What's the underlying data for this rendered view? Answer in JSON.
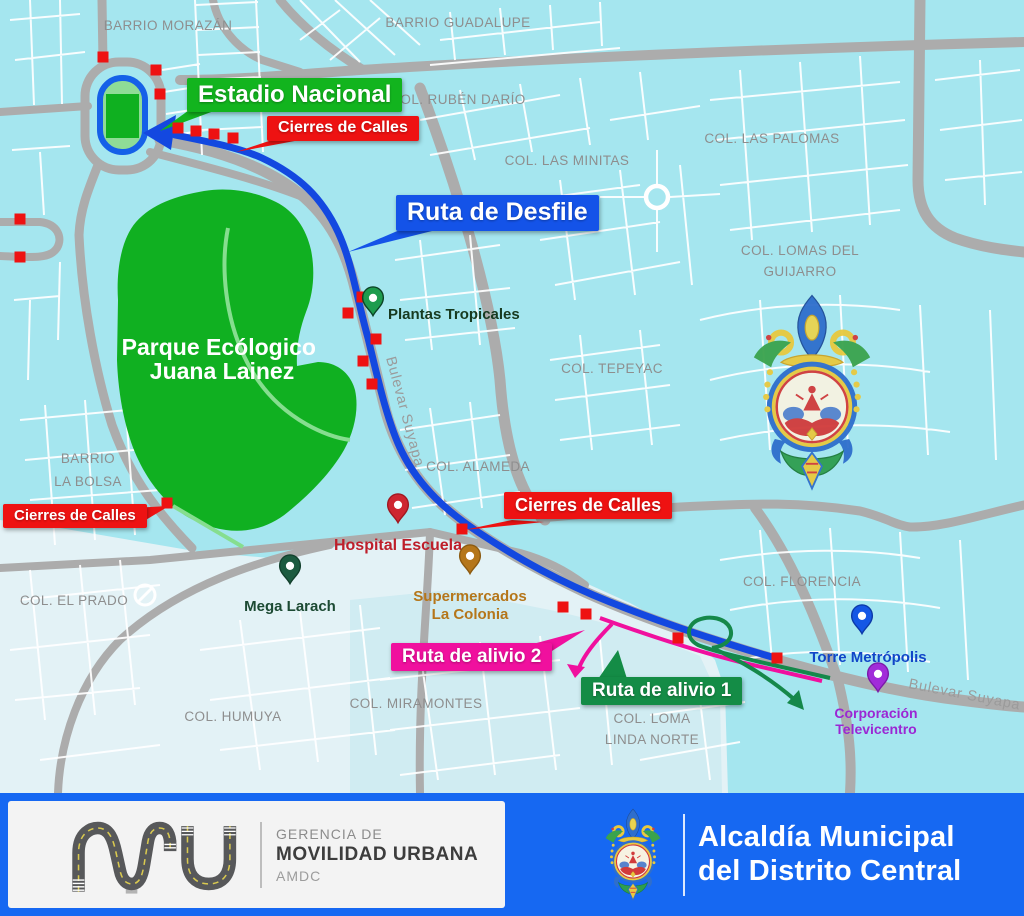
{
  "map": {
    "colors": {
      "map_bg": "#A5E6EF",
      "light_zone": "#E3F2F6",
      "mid_zone": "#CBEAF1",
      "roads": "#ACACAC",
      "streets": "#FFFFFF",
      "park_green": "#10B021",
      "route_desfile_blue": "#1348E0",
      "route_alivio1_green": "#15884A",
      "route_alivio2_pink": "#F0109E",
      "closure_red": "#EE1212"
    },
    "park_name": [
      "Parque Ecólogico",
      "Juana Lainez"
    ],
    "neighborhoods": [
      {
        "lines": [
          "BARRIO MORAZÁN"
        ],
        "x": 168,
        "y": 30
      },
      {
        "lines": [
          "BARRIO GUADALUPE"
        ],
        "x": 458,
        "y": 27
      },
      {
        "lines": [
          "COL. RUBÉN DARÍO"
        ],
        "x": 458,
        "y": 104
      },
      {
        "lines": [
          "COL. LAS MINITAS"
        ],
        "x": 567,
        "y": 165
      },
      {
        "lines": [
          "COL. LAS PALOMAS"
        ],
        "x": 772,
        "y": 143
      },
      {
        "lines": [
          "COL. LOMAS DEL",
          "GUIJARRO"
        ],
        "x": 800,
        "y": 255,
        "lh": 21
      },
      {
        "lines": [
          "COL. TEPEYAC"
        ],
        "x": 612,
        "y": 373
      },
      {
        "lines": [
          "COL. ALAMEDA"
        ],
        "x": 478,
        "y": 471
      },
      {
        "lines": [
          "BARRIO",
          "LA BOLSA"
        ],
        "x": 88,
        "y": 463,
        "lh": 23
      },
      {
        "lines": [
          "COL. EL PRADO"
        ],
        "x": 74,
        "y": 605
      },
      {
        "lines": [
          "COL. FLORENCIA"
        ],
        "x": 802,
        "y": 586
      },
      {
        "lines": [
          "COL. HUMUYA"
        ],
        "x": 233,
        "y": 721
      },
      {
        "lines": [
          "COL. MIRAMONTES"
        ],
        "x": 416,
        "y": 708
      },
      {
        "lines": [
          "COL. LOMA",
          "LINDA NORTE"
        ],
        "x": 652,
        "y": 723,
        "lh": 21
      }
    ],
    "street_names": [
      {
        "text": "Bulevar Suyapa",
        "x": 386,
        "y": 358,
        "rotate": 75
      },
      {
        "text": "Bulevar Suyapa",
        "x": 908,
        "y": 688,
        "rotate": 11
      }
    ],
    "pois": [
      {
        "id": "plantas-tropicales",
        "lines": [
          "Plantas Tropicales"
        ],
        "x": 373,
        "y": 314,
        "pin": "#1E9C4E",
        "pin_stroke": "#0C4426",
        "text_color": "#173A20",
        "tx": 388,
        "ty": 319,
        "anchor": "start",
        "fs": 15,
        "lh": 17
      },
      {
        "id": "hospital-escuela",
        "lines": [
          "Hospital Escuela"
        ],
        "x": 398,
        "y": 521,
        "pin": "#CE2630",
        "pin_stroke": "#A01820",
        "text_color": "#BE1E2A",
        "tx": 398,
        "ty": 550,
        "anchor": "middle",
        "fs": 16,
        "lh": 18
      },
      {
        "id": "mega-larach",
        "lines": [
          "Mega Larach"
        ],
        "x": 290,
        "y": 582,
        "pin": "#1C5B40",
        "pin_stroke": "#12402C",
        "text_color": "#1C4A33",
        "tx": 290,
        "ty": 611,
        "anchor": "middle",
        "fs": 15,
        "lh": 17
      },
      {
        "id": "supermercados-la-colonia",
        "lines": [
          "Supermercados",
          "La Colonia"
        ],
        "x": 470,
        "y": 572,
        "pin": "#B5761A",
        "pin_stroke": "#8C5A10",
        "text_color": "#B5761A",
        "tx": 470,
        "ty": 601,
        "anchor": "middle",
        "fs": 15,
        "lh": 18
      },
      {
        "id": "torre-metropolis",
        "lines": [
          "Torre Metrópolis"
        ],
        "x": 862,
        "y": 632,
        "pin": "#1457E5",
        "pin_stroke": "#0C3AA8",
        "text_color": "#1146C8",
        "tx": 868,
        "ty": 662,
        "anchor": "middle",
        "fs": 15,
        "lh": 17
      },
      {
        "id": "corporacion-televicentro",
        "lines": [
          "Corporación",
          "Televicentro"
        ],
        "x": 878,
        "y": 690,
        "pin": "#A12CD9",
        "pin_stroke": "#7A1BA8",
        "text_color": "#9B27D4",
        "tx": 876,
        "ty": 718,
        "anchor": "middle",
        "fs": 14,
        "lh": 16
      }
    ],
    "closures": [
      [
        103,
        57
      ],
      [
        156,
        70
      ],
      [
        160,
        94
      ],
      [
        20,
        219
      ],
      [
        20,
        257
      ],
      [
        178,
        128
      ],
      [
        196,
        131
      ],
      [
        214,
        134
      ],
      [
        233,
        138
      ],
      [
        362,
        297
      ],
      [
        348,
        313
      ],
      [
        376,
        339
      ],
      [
        363,
        361
      ],
      [
        372,
        384
      ],
      [
        167,
        503
      ],
      [
        462,
        529
      ],
      [
        563,
        607
      ],
      [
        586,
        614
      ],
      [
        678,
        638
      ],
      [
        777,
        658
      ]
    ],
    "callouts": [
      {
        "id": "estadio-nacional",
        "text": "Estadio Nacional",
        "x": 187,
        "y": 78,
        "fs": 24,
        "color": "#12B41E",
        "tail": "192,108 222,108 160,131"
      },
      {
        "id": "cierres-top",
        "text": "Cierres de Calles",
        "x": 267,
        "y": 116,
        "fs": 16,
        "color": "#EE1212",
        "tail": "272,140 300,140 236,152"
      },
      {
        "id": "ruta-desfile",
        "text": "Ruta de Desfile",
        "x": 396,
        "y": 195,
        "fs": 25,
        "color": "#1453E8",
        "tail": "402,229 432,231 348,252"
      },
      {
        "id": "cierres-left",
        "text": "Cierres de Calles",
        "x": 3,
        "y": 504,
        "fs": 15,
        "color": "#EE1212",
        "tail": "132,508 134,527 169,506"
      },
      {
        "id": "cierres-center",
        "text": "Cierres de Calles",
        "x": 504,
        "y": 492,
        "fs": 18,
        "color": "#EE1212",
        "tail": "512,520 544,522 464,530"
      },
      {
        "id": "ruta-alivio-2",
        "text": "Ruta de alivio 2",
        "x": 391,
        "y": 643,
        "fs": 19,
        "color": "#F0109E",
        "tail": "518,648 544,656 585,630"
      },
      {
        "id": "ruta-alivio-1",
        "text": "Ruta de alivio 1",
        "x": 581,
        "y": 677,
        "fs": 19,
        "color": "#148C46",
        "tail": "596,682 628,682 618,650"
      }
    ]
  },
  "footer": {
    "bg": "#1668F2",
    "left": {
      "line1": "GERENCIA DE",
      "line2": "MOVILIDAD URBANA",
      "line3": "AMDC"
    },
    "right": {
      "line1": "Alcaldía Municipal",
      "line2": "del Distrito Central"
    }
  }
}
